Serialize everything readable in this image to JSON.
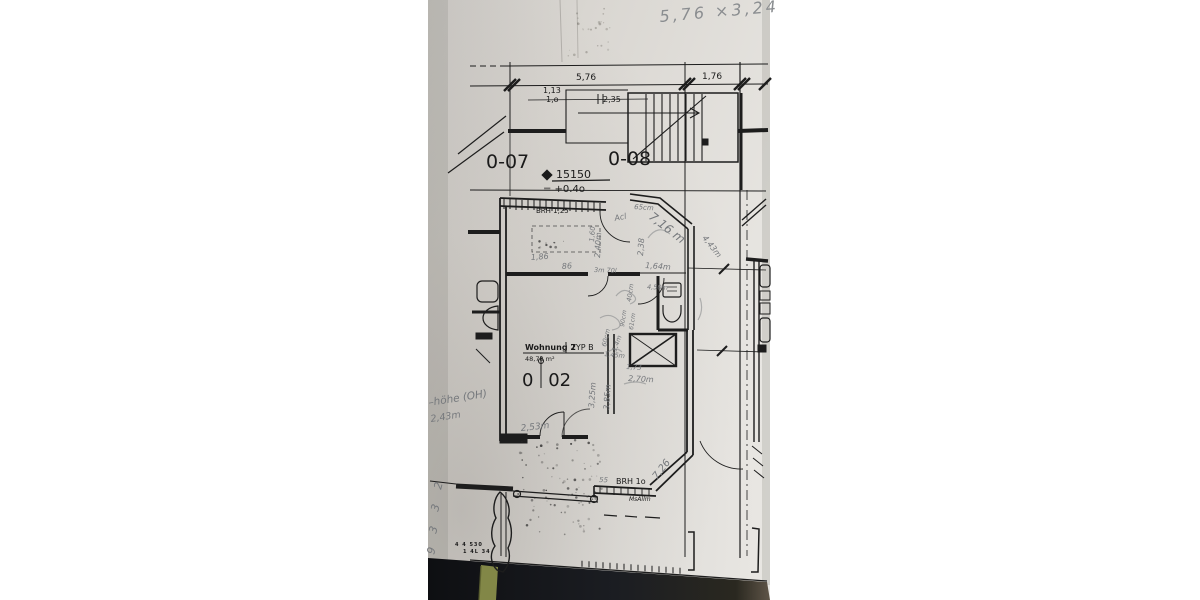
{
  "plan": {
    "handwritten_header": "5,76 ×3,24",
    "room_labels": {
      "left": "0-07",
      "stair": "0-08"
    },
    "apartment_box": {
      "name": "Wohnung 2",
      "type": "TYP B",
      "area": "48,78 m²",
      "number_left": "0",
      "number_right": "02"
    },
    "elevation": {
      "value": "15150",
      "offset": "= +0.4o"
    },
    "printed_dims": {
      "top_main": "5,76",
      "top_right": "1,76",
      "sub1": "1,13",
      "sub2": "1,o",
      "stair": "2,35"
    },
    "wall_notes": {
      "top": "BRH 1,25",
      "bottom": "BRH 1o",
      "cursive": "MsAllm"
    },
    "tiny_print": {
      "row1": "4 4 530",
      "row2": "1 4L 34"
    },
    "margin_notes": {
      "line1": "–höhe (OH)",
      "line2": "2,43m",
      "marks": [
        "2",
        "3",
        "3",
        "9"
      ]
    },
    "annotations": [
      "65cm",
      "Acl",
      "7,16 m",
      "2,38",
      "2,40m",
      "4,43m",
      "1,64m",
      "1,86",
      "86",
      "1,60",
      "3m 70l",
      "4,50m",
      "40cm",
      "60cm",
      "1,4m",
      "2,70m",
      "1,73",
      "3,85m",
      "3,25m",
      "2,53m",
      "90cm",
      "61cm",
      "7,26",
      "55",
      "1,45m"
    ],
    "colors": {
      "paper": "#d9d6d1",
      "ink": "#1d1d1d",
      "pencil": "#7a7d80",
      "table": "#15161a",
      "marker_strip": "#8c914c"
    }
  }
}
